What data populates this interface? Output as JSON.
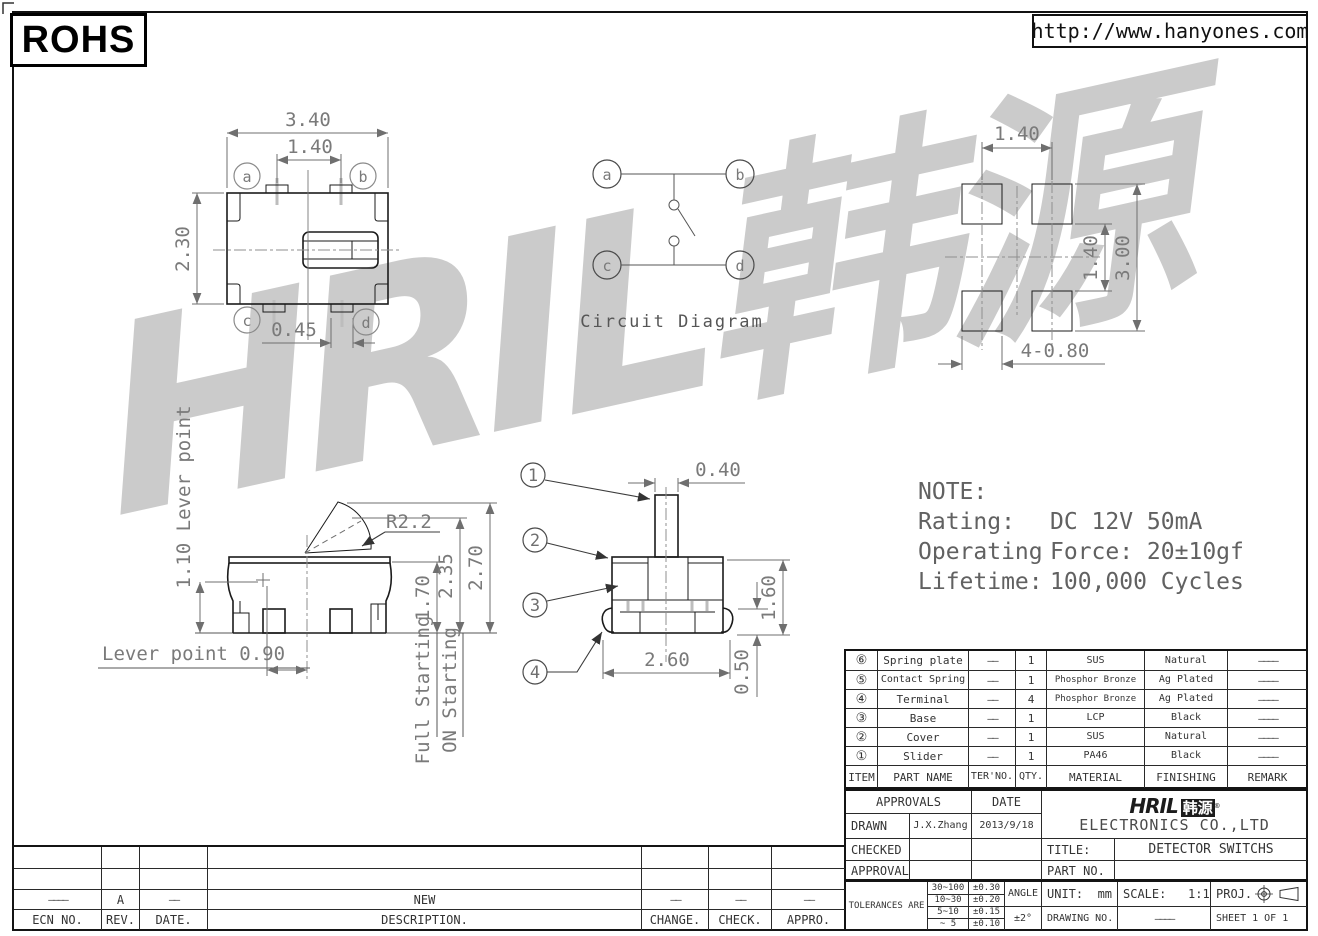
{
  "page": {
    "rohs": "ROHS",
    "url": "http://www.hanyones.com"
  },
  "watermark": {
    "text": "HRIL韩源"
  },
  "top_view": {
    "dims": {
      "width": "3.40",
      "pin_pitch": "1.40",
      "depth": "2.30",
      "pad": "0.45"
    },
    "terminals": [
      "a",
      "b",
      "c",
      "d"
    ]
  },
  "circuit": {
    "title": "Circuit Diagram",
    "terminals": [
      "a",
      "b",
      "c",
      "d"
    ]
  },
  "pcb": {
    "dims": {
      "pitch_x": "1.40",
      "pitch_y": "1.40",
      "height": "3.00",
      "pads": "4-0.80"
    }
  },
  "side_view": {
    "labels": {
      "lever_height": "1.10 Lever point",
      "lever_offset": "Lever point 0.90",
      "radius": "R2.2",
      "full": "Full Starting",
      "on": "ON Starting"
    },
    "dims": {
      "body": "1.70",
      "full_travel": "2.35",
      "free": "2.70"
    }
  },
  "front_view": {
    "dims": {
      "shaft": "0.40",
      "body": "2.60",
      "height": "1.60",
      "terminal": "0.50"
    },
    "callouts": [
      "1",
      "2",
      "3",
      "4"
    ]
  },
  "note": {
    "title": "NOTE:",
    "lines": [
      {
        "label": "Rating:",
        "value": "DC 12V 50mA"
      },
      {
        "label": "Operating",
        "value": "Force: 20±10gf"
      },
      {
        "label": "Lifetime:",
        "value": "100,000 Cycles"
      }
    ]
  },
  "parts_table": {
    "headers": [
      "ITEM",
      "PART NAME",
      "TER'NO.",
      "QTY.",
      "MATERIAL",
      "FINISHING",
      "REMARK"
    ],
    "rows": [
      {
        "item": "⑥",
        "name": "Spring plate",
        "ter": "——",
        "qty": "1",
        "material": "SUS",
        "finishing": "Natural",
        "remark": "————"
      },
      {
        "item": "⑤",
        "name": "Contact Spring",
        "ter": "——",
        "qty": "1",
        "material": "Phosphor Bronze",
        "finishing": "Ag Plated",
        "remark": "————"
      },
      {
        "item": "④",
        "name": "Terminal",
        "ter": "——",
        "qty": "4",
        "material": "Phosphor Bronze",
        "finishing": "Ag Plated",
        "remark": "————"
      },
      {
        "item": "③",
        "name": "Base",
        "ter": "——",
        "qty": "1",
        "material": "LCP",
        "finishing": "Black",
        "remark": "————"
      },
      {
        "item": "②",
        "name": "Cover",
        "ter": "——",
        "qty": "1",
        "material": "SUS",
        "finishing": "Natural",
        "remark": "————"
      },
      {
        "item": "①",
        "name": "Slider",
        "ter": "——",
        "qty": "1",
        "material": "PA46",
        "finishing": "Black",
        "remark": "————"
      }
    ]
  },
  "title_block": {
    "approvals": "APPROVALS",
    "date": "DATE",
    "drawn": "DRAWN",
    "drawn_by": "J.X.Zhang",
    "drawn_date": "2013/9/18",
    "checked": "CHECKED",
    "approvals2": "APPROVALS",
    "logo_text": "HRIL",
    "logo_cjk": "韩源",
    "logo_reg": "®",
    "company": "ELECTRONICS CO.,LTD",
    "title_label": "TITLE:",
    "title": "DETECTOR SWITCHS",
    "part_no_label": "PART NO."
  },
  "tolerance_block": {
    "label": "TOLERANCES ARE",
    "rows": [
      {
        "range": "30~100",
        "tol": "±0.30"
      },
      {
        "range": "10~30",
        "tol": "±0.20"
      },
      {
        "range": "5~10",
        "tol": "±0.15"
      },
      {
        "range": "~ 5",
        "tol": "±0.10"
      }
    ],
    "angle_label": "ANGLE",
    "angle_value": "±2°",
    "unit_label": "UNIT:",
    "unit_value": "mm",
    "scale_label": "SCALE:",
    "scale_value": "1:1",
    "proj_label": "PROJ.",
    "drawing_label": "DRAWING NO.",
    "drawing_value": "————",
    "sheet": "SHEET  1 OF 1"
  },
  "revision_table": {
    "headers": [
      "ECN NO.",
      "REV.",
      "DATE.",
      "DESCRIPTION.",
      "CHANGE.",
      "CHECK.",
      "APPRO."
    ],
    "row": [
      "————",
      "A",
      "——",
      "NEW",
      "——",
      "——",
      "——"
    ]
  }
}
